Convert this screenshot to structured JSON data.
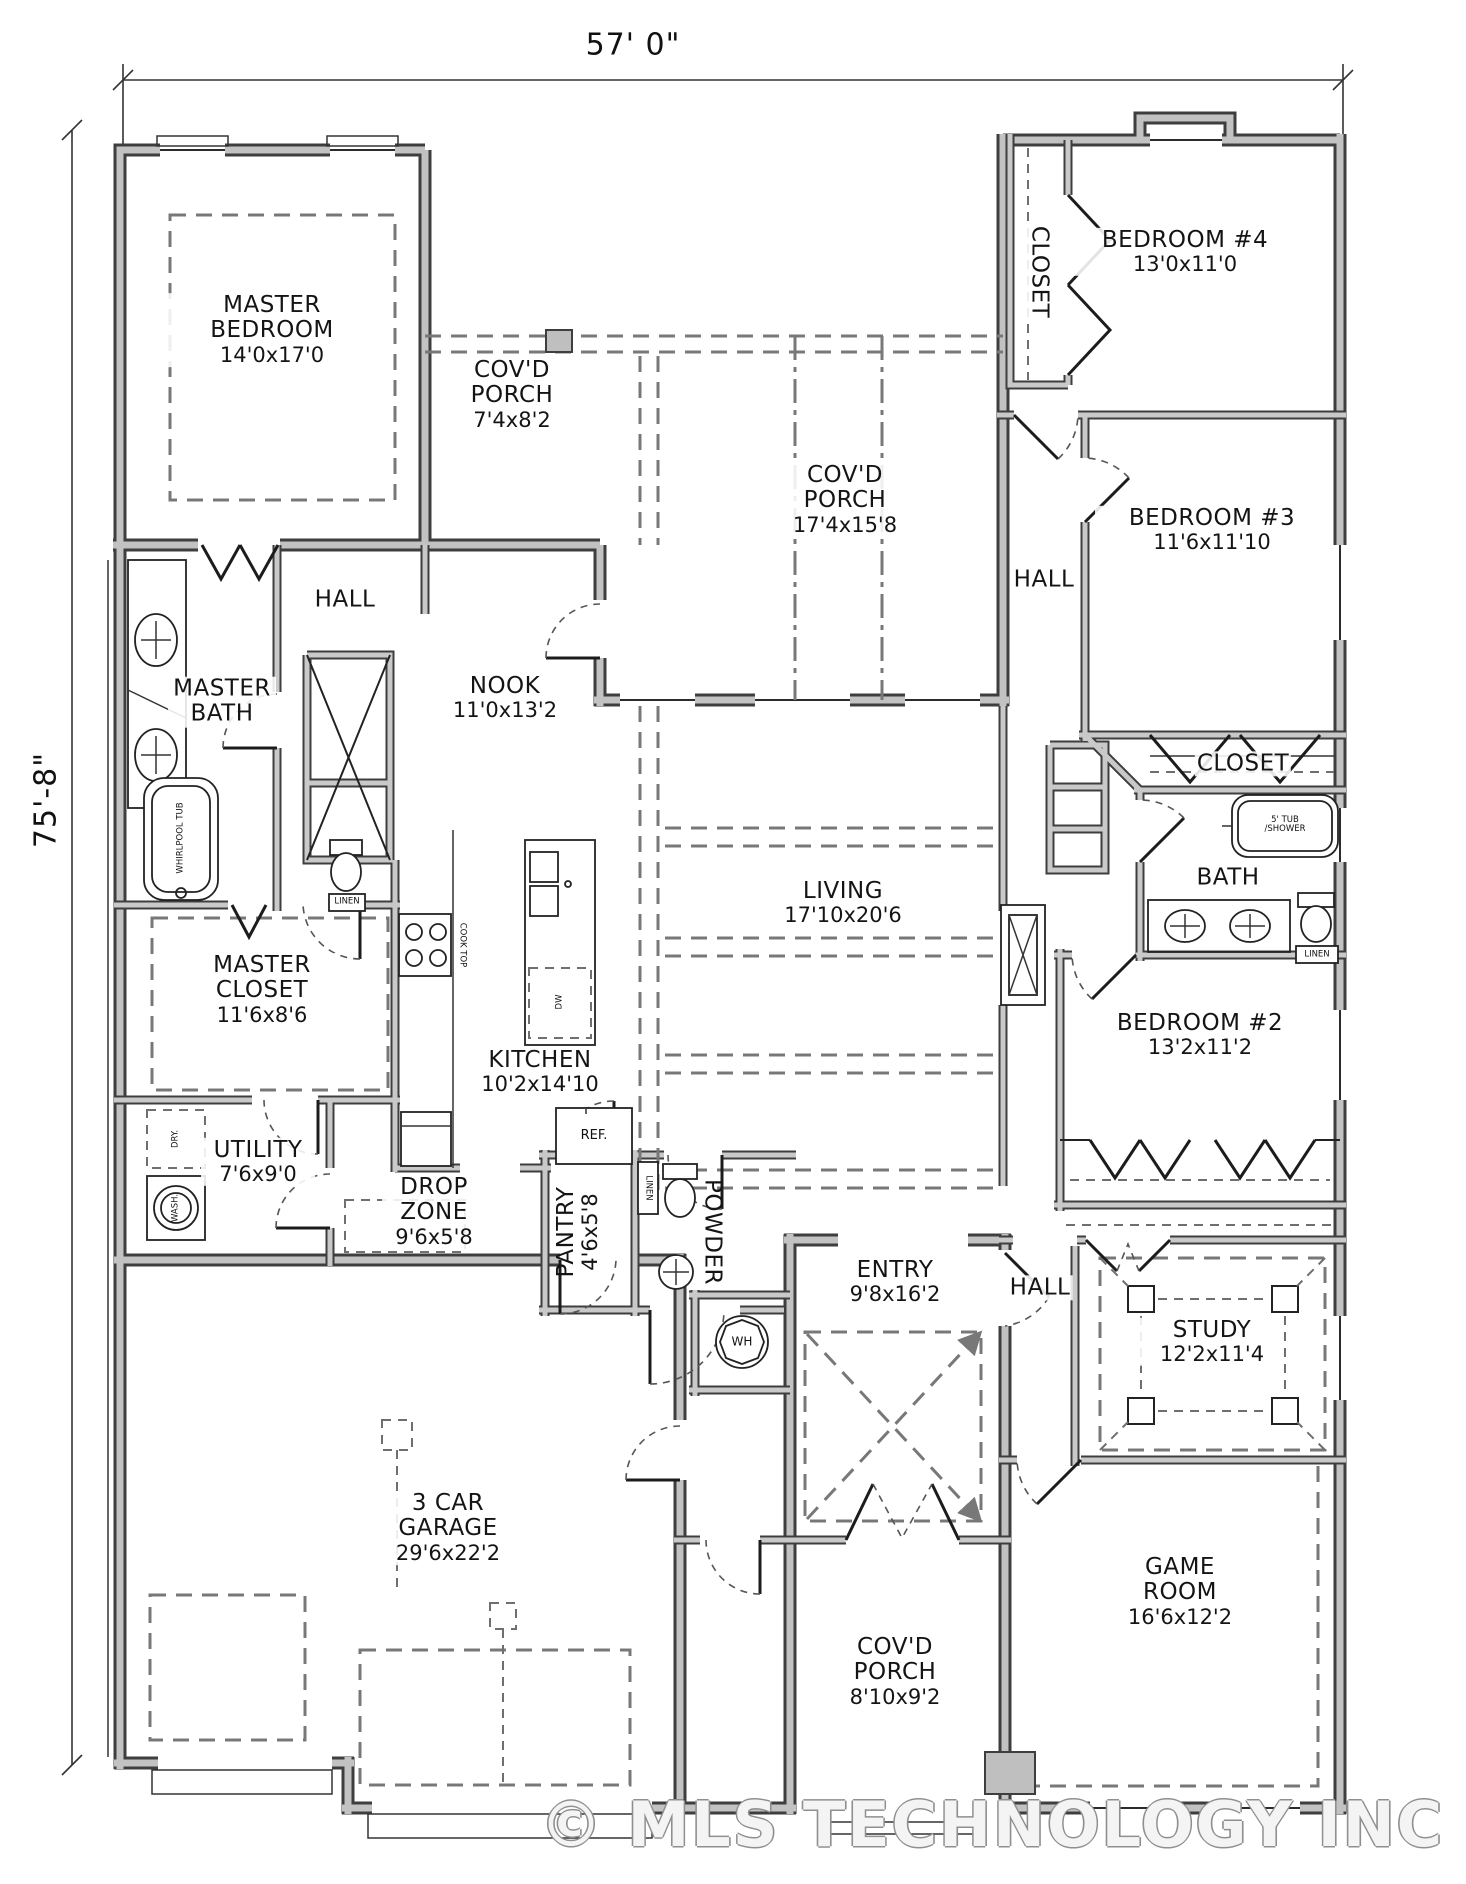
{
  "plan": {
    "dimensions": {
      "width_label": "57' 0\"",
      "height_label": "75'-8\""
    },
    "watermark": "© MLS TECHNOLOGY INC 2026",
    "rooms": [
      {
        "id": "master-bedroom",
        "name": "MASTER BEDROOM",
        "dims": "14'0x17'0"
      },
      {
        "id": "covd-porch-small",
        "name": "COV'D PORCH",
        "dims": "7'4x8'2"
      },
      {
        "id": "covd-porch-large",
        "name": "COV'D PORCH",
        "dims": "17'4x15'8"
      },
      {
        "id": "bedroom-4",
        "name": "BEDROOM #4",
        "dims": "13'0x11'0"
      },
      {
        "id": "closet-bed4",
        "name": "CLOSET",
        "dims": ""
      },
      {
        "id": "hall-top-right",
        "name": "HALL",
        "dims": ""
      },
      {
        "id": "bedroom-3",
        "name": "BEDROOM #3",
        "dims": "11'6x11'10"
      },
      {
        "id": "hall-master",
        "name": "HALL",
        "dims": ""
      },
      {
        "id": "master-bath",
        "name": "MASTER BATH",
        "dims": ""
      },
      {
        "id": "nook",
        "name": "NOOK",
        "dims": "11'0x13'2"
      },
      {
        "id": "closet-right",
        "name": "CLOSET",
        "dims": ""
      },
      {
        "id": "bath",
        "name": "BATH",
        "dims": ""
      },
      {
        "id": "living",
        "name": "LIVING",
        "dims": "17'10x20'6"
      },
      {
        "id": "master-closet",
        "name": "MASTER CLOSET",
        "dims": "11'6x8'6"
      },
      {
        "id": "bedroom-2",
        "name": "BEDROOM #2",
        "dims": "13'2x11'2"
      },
      {
        "id": "kitchen",
        "name": "KITCHEN",
        "dims": "10'2x14'10"
      },
      {
        "id": "utility",
        "name": "UTILITY",
        "dims": "7'6x9'0"
      },
      {
        "id": "drop-zone",
        "name": "DROP ZONE",
        "dims": "9'6x5'8"
      },
      {
        "id": "pantry",
        "name": "PANTRY",
        "dims": "4'6x5'8"
      },
      {
        "id": "powder",
        "name": "POWDER",
        "dims": ""
      },
      {
        "id": "entry",
        "name": "ENTRY",
        "dims": "9'8x16'2"
      },
      {
        "id": "hall-study",
        "name": "HALL",
        "dims": ""
      },
      {
        "id": "study",
        "name": "STUDY",
        "dims": "12'2x11'4"
      },
      {
        "id": "garage",
        "name": "3 CAR GARAGE",
        "dims": "29'6x22'2"
      },
      {
        "id": "covd-porch-front",
        "name": "COV'D PORCH",
        "dims": "8'10x9'2"
      },
      {
        "id": "game-room",
        "name": "GAME ROOM",
        "dims": "16'6x12'2"
      }
    ],
    "fixtures": {
      "ref": "REF.",
      "wh": "WH",
      "dry": "DRY.",
      "wash": "WASH.",
      "linen": "LINEN",
      "tub_shower": "5' TUB /SHOWER",
      "whirlpool": "WHIRLPOOL TUB",
      "cooktop": "COOK TOP",
      "dw": "DW"
    }
  }
}
